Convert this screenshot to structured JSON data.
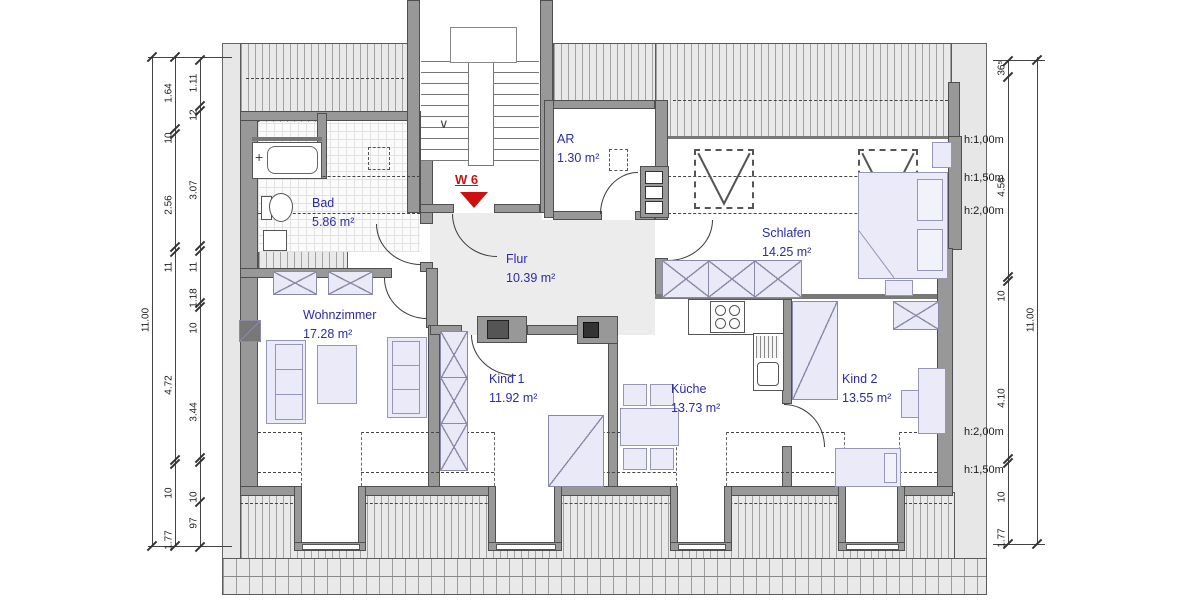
{
  "plan": {
    "unit": {
      "label": "W 6"
    },
    "rooms": [
      {
        "name": "Bad",
        "area": "5.86 m²"
      },
      {
        "name": "AR",
        "area": "1.30 m²"
      },
      {
        "name": "Flur",
        "area": "10.39 m²"
      },
      {
        "name": "Schlafen",
        "area": "14.25 m²"
      },
      {
        "name": "Wohnzimmer",
        "area": "17.28 m²"
      },
      {
        "name": "Kind 1",
        "area": "11.92 m²"
      },
      {
        "name": "Küche",
        "area": "13.73 m²"
      },
      {
        "name": "Kind 2",
        "area": "13.55 m²"
      }
    ],
    "dims": {
      "left_outer": [
        "11.00"
      ],
      "left_mid": [
        "1.64",
        "10",
        "2.56",
        "11",
        "4.72",
        "10",
        "1.77"
      ],
      "left_inner": [
        "1.11",
        "12",
        "3.07",
        "11",
        "1.18",
        "10",
        "3.44",
        "10",
        "97"
      ],
      "right_inner": [
        "36⁵",
        "4.56",
        "10",
        "4.10",
        "10",
        "1.77"
      ],
      "right_outer": [
        "11.00"
      ]
    },
    "height_lines": {
      "top": [
        "h:1,00m",
        "h:1,50m",
        "h:2,00m"
      ],
      "bottom": [
        "h:2,00m",
        "h:1,50m"
      ]
    },
    "stairs": {
      "arrow": "∨"
    },
    "colors": {
      "label_blue": "#2b2ba6",
      "unit_red": "#cc1111",
      "wall_gray": "#989898",
      "surround_gray": "#e7e7e7"
    }
  }
}
